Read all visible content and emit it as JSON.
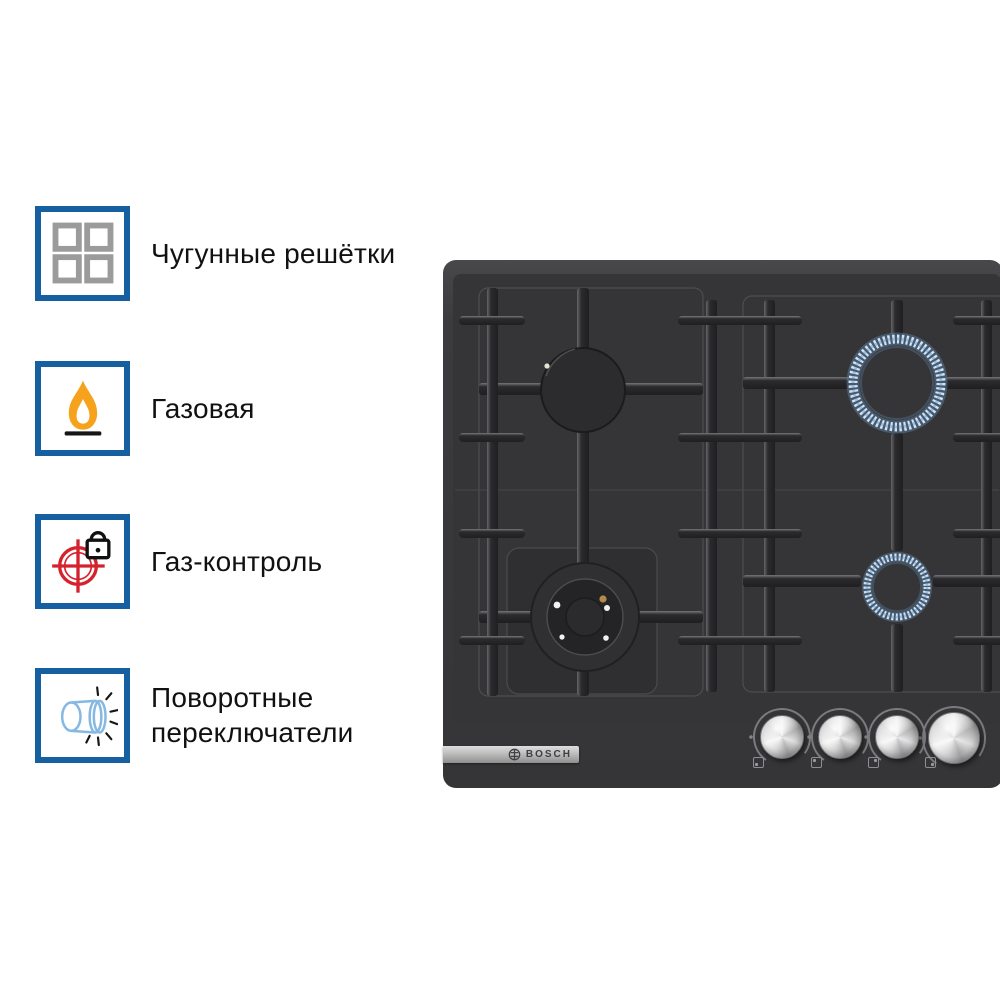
{
  "features": [
    {
      "icon": "cast-iron-grates-icon",
      "label": "Чугунные решётки"
    },
    {
      "icon": "gas-flame-icon",
      "label": "Газовая"
    },
    {
      "icon": "gas-control-icon",
      "label": "Газ-контроль"
    },
    {
      "icon": "rotary-switches-icon",
      "label": "Поворотные переключатели"
    }
  ],
  "product": {
    "brand": "BOSCH",
    "type": "built-in gas hob, black",
    "burners": [
      {
        "position": "back-left",
        "state": "off",
        "size": "standard"
      },
      {
        "position": "front-left",
        "state": "off",
        "size": "wok"
      },
      {
        "position": "back-right",
        "state": "lit",
        "size": "large"
      },
      {
        "position": "front-right",
        "state": "lit",
        "size": "small"
      }
    ],
    "knob_count": 4
  },
  "colors": {
    "accent_blue": "#1660a2",
    "icon_gray": "#9b9b9b",
    "flame_orange": "#f6a21c",
    "control_red": "#d5232e",
    "knob_icon_blue": "#85b8e3",
    "lit_flame_blue": "#cfe4f6",
    "hob_body": "#3a3a3c",
    "background": "#ffffff",
    "text": "#111111"
  }
}
